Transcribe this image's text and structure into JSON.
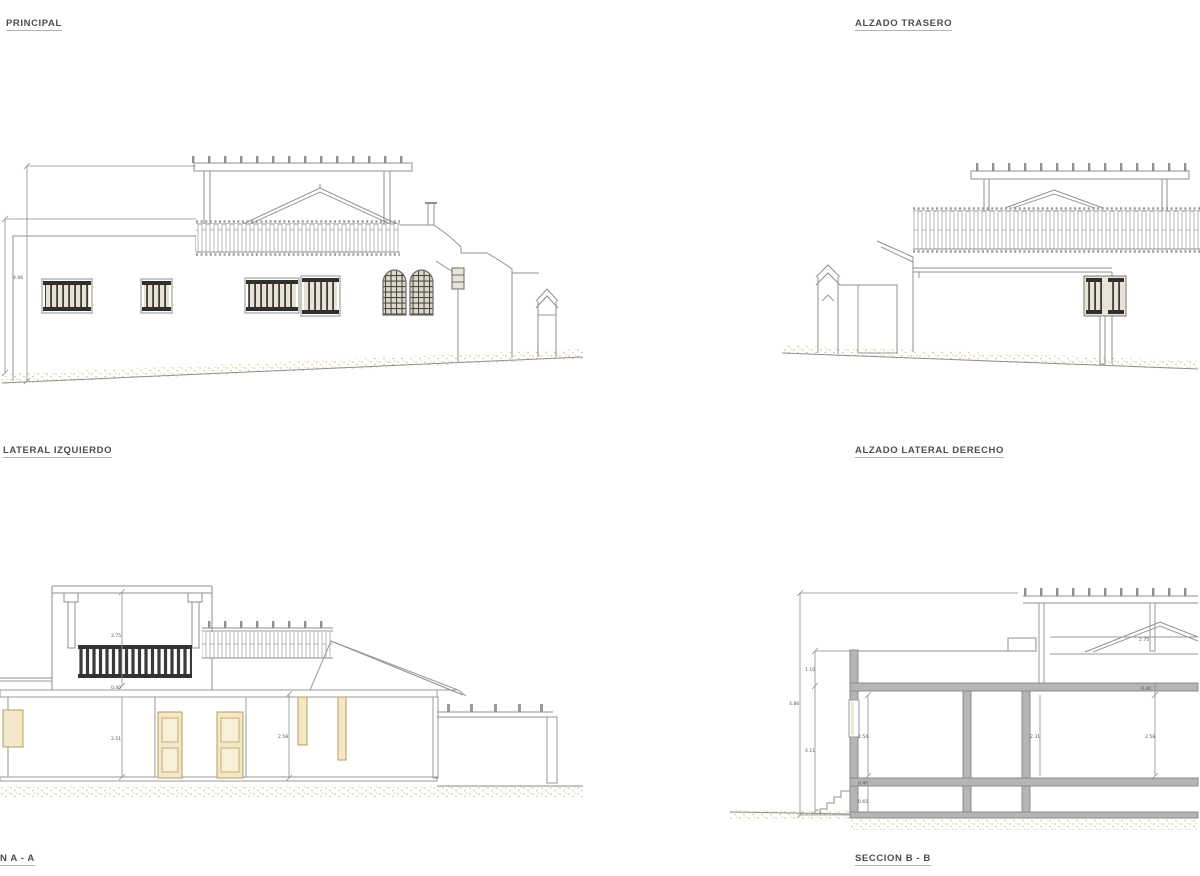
{
  "labels": {
    "principal": "PRINCIPAL",
    "trasero": "ALZADO TRASERO",
    "lateral_izquierdo": "LATERAL IZQUIERDO",
    "lateral_derecho": "ALZADO LATERAL DERECHO",
    "seccion_a": "N A - A",
    "seccion_b": "SECCION B - B"
  },
  "dims": {
    "principal": {
      "total_height": "4.96"
    },
    "seccion_a": {
      "upper": "2.75",
      "slab": "0.40",
      "room_left": "2.51",
      "room_right": "2.58"
    },
    "seccion_b": {
      "total": "4.86",
      "upper": "1.10",
      "lower": "4.11",
      "room1": "2.54",
      "room2": "2.31",
      "room3": "2.58",
      "slab": "0.40",
      "crawl": "0.65",
      "gable": "2.75",
      "slab_right": "0.40"
    }
  },
  "colors": {
    "line_gray": "#8f8f8f",
    "grille_dark": "#3a3a3a",
    "poche_gray": "#b5b5b5",
    "wood_beige": "#f3e8c9",
    "ground_tan": "#d6c89e",
    "label_text": "#4d4d4d"
  }
}
